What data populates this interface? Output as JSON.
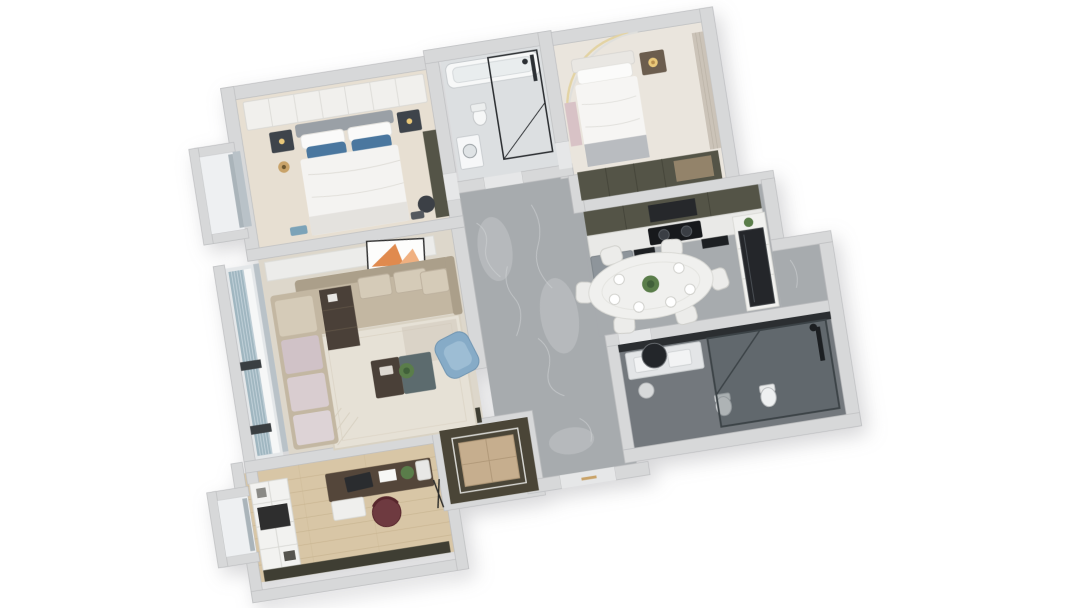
{
  "scene": {
    "description": "3D isometric top-down rendering of a three-bedroom apartment floor plan on a white background, rotated about 9 degrees counterclockwise",
    "background": "#ffffff",
    "rotation_deg": -9
  },
  "palette": {
    "wall": "#d7d8d9",
    "wallEdge": "#bfc0c2",
    "threshold": "#e6e7e8",
    "marble": "#a7abae",
    "marbleVein": "#c9ccce",
    "floorMaster": "#e7dfd2",
    "floorBed2": "#eae5dd",
    "floorLiving": "#ddd7cb",
    "floorBath1": "#dcdfe1",
    "floorBath2": "#73787d",
    "floorStudy": "#d8c6a6",
    "floorBay": "#eef0f2",
    "floorBalcony": "#e4e7e9",
    "oliveCabinet": "#545447",
    "oliveDark": "#3f3e33",
    "whiteLinen": "#f4f3f1",
    "softWhite": "#ececea",
    "bedHeadboard": "#9aa0a6",
    "pillowBlue": "#4a779f",
    "nightstand": "#3e444b",
    "gold": "#c9a369",
    "goldGlow": "#e9c87a",
    "sofaBase": "#c3b7a2",
    "sofaBack": "#ab9f8a",
    "sofaCushion": "#d5cbb8",
    "sofaMauve": "#d0c2c7",
    "armchairBlue": "#86abc7",
    "armchairBlueLight": "#9dbdd4",
    "rug": "#e6e1d6",
    "rugShade": "#cfc9bc",
    "tableDark": "#4a4038",
    "tableTeal": "#5c6b6e",
    "plantGreen": "#5a7d4a",
    "plantDark": "#41603a",
    "artworkOrange": "#e08a4e",
    "counter": "#e9e9e7",
    "cooktop": "#17191c",
    "fridgeGray": "#8e959b",
    "fridgeBlack": "#24262a",
    "curtain": "#9fb6c0",
    "curtainLight": "#c3d2da",
    "wardrobeTan": "#c6ae8e",
    "closetDark": "#4a4537",
    "deskWood": "#54463a",
    "chairMaroon": "#6e3a40",
    "fixtureDark": "#2c3034",
    "mirrorDark": "#23262a",
    "diningTable": "#f0f0ee",
    "chairWhite": "#ececea",
    "pinkShelf": "#d8c2c6",
    "woodPanel": "#cbc3b8",
    "throwGray": "#b9bcc0",
    "laundryWhite": "#f6f7f8",
    "glassFrame": "#3c4347",
    "windowGlass": "#b9c2c8",
    "coveLight": "#e3d3a3"
  },
  "rooms": {
    "master_bedroom": {
      "name": "master bedroom",
      "floor_color": "#e7dfd2",
      "furniture": [
        "white-wardrobe-row",
        "double-bed",
        "blue-pillows",
        "two-nightstands",
        "gold-pendant-lamp",
        "dark-armchair",
        "tall-olive-cabinet",
        "window-bay"
      ]
    },
    "bathroom_top": {
      "name": "family bathroom",
      "floor_color": "#dcdfe1",
      "furniture": [
        "bathtub",
        "black-frame-shower",
        "washing-machine",
        "toilet"
      ]
    },
    "bedroom_2": {
      "name": "second bedroom",
      "floor_color": "#eae5dd",
      "furniture": [
        "double-bed",
        "wood-nightstand",
        "glowing-table-lamp",
        "olive-wardrobe",
        "curved-cove-light",
        "pink-shelf",
        "wood-wall-panel"
      ]
    },
    "kitchen": {
      "name": "kitchen",
      "floor_color": "#a7abae",
      "furniture": [
        "olive-upper-cabinets",
        "range-hood",
        "white-counter",
        "black-cooktop",
        "gray-refrigerator",
        "dark-base-cabinets",
        "tall-white-shelf",
        "black-glass-fridge"
      ]
    },
    "dining_area": {
      "name": "dining area",
      "floor_color": "#a7abae",
      "furniture": [
        "oval-white-table",
        "six-white-chairs",
        "place-settings",
        "plant-centerpiece"
      ]
    },
    "living_room": {
      "name": "living room",
      "floor_color": "#ddd7cb",
      "furniture": [
        "tv-console",
        "leaning-orange-artwork",
        "l-shaped-beige-sofa",
        "mauve-chaise-cushions",
        "dark-side-table",
        "two-tone-coffee-table",
        "potted-plant",
        "blue-armchair",
        "patterned-rug",
        "low-olive-cabinet"
      ]
    },
    "balcony": {
      "name": "living room balcony",
      "floor_color": "#e4e7e9",
      "furniture": [
        "blue-gray-curtains",
        "sheer-curtain",
        "window-wall"
      ]
    },
    "hallway": {
      "name": "hallway",
      "floor_color": "#a7abae",
      "furniture": []
    },
    "study": {
      "name": "study",
      "floor_color": "#d8c6a6",
      "furniture": [
        "white-bookshelf",
        "wall-tv",
        "walnut-desk",
        "laptop",
        "desk-plant",
        "maroon-office-chair",
        "low-olive-cabinet",
        "window-bay"
      ]
    },
    "entry_closet": {
      "name": "entry closet",
      "floor_color": "#4a4537",
      "furniture": [
        "tan-wardrobe-cabinet"
      ]
    },
    "foyer": {
      "name": "entry foyer",
      "floor_color": "#a7abae",
      "furniture": [
        "entry-door-threshold",
        "gold-door-handle"
      ]
    },
    "bathroom_master": {
      "name": "dark en-suite bathroom",
      "floor_color": "#73787d",
      "furniture": [
        "double-sink-vanity",
        "round-black-mirror",
        "vanity-stool",
        "two-toilets",
        "glass-shower-enclosure",
        "black-shower-column",
        "mirror-cabinet-band"
      ]
    }
  }
}
